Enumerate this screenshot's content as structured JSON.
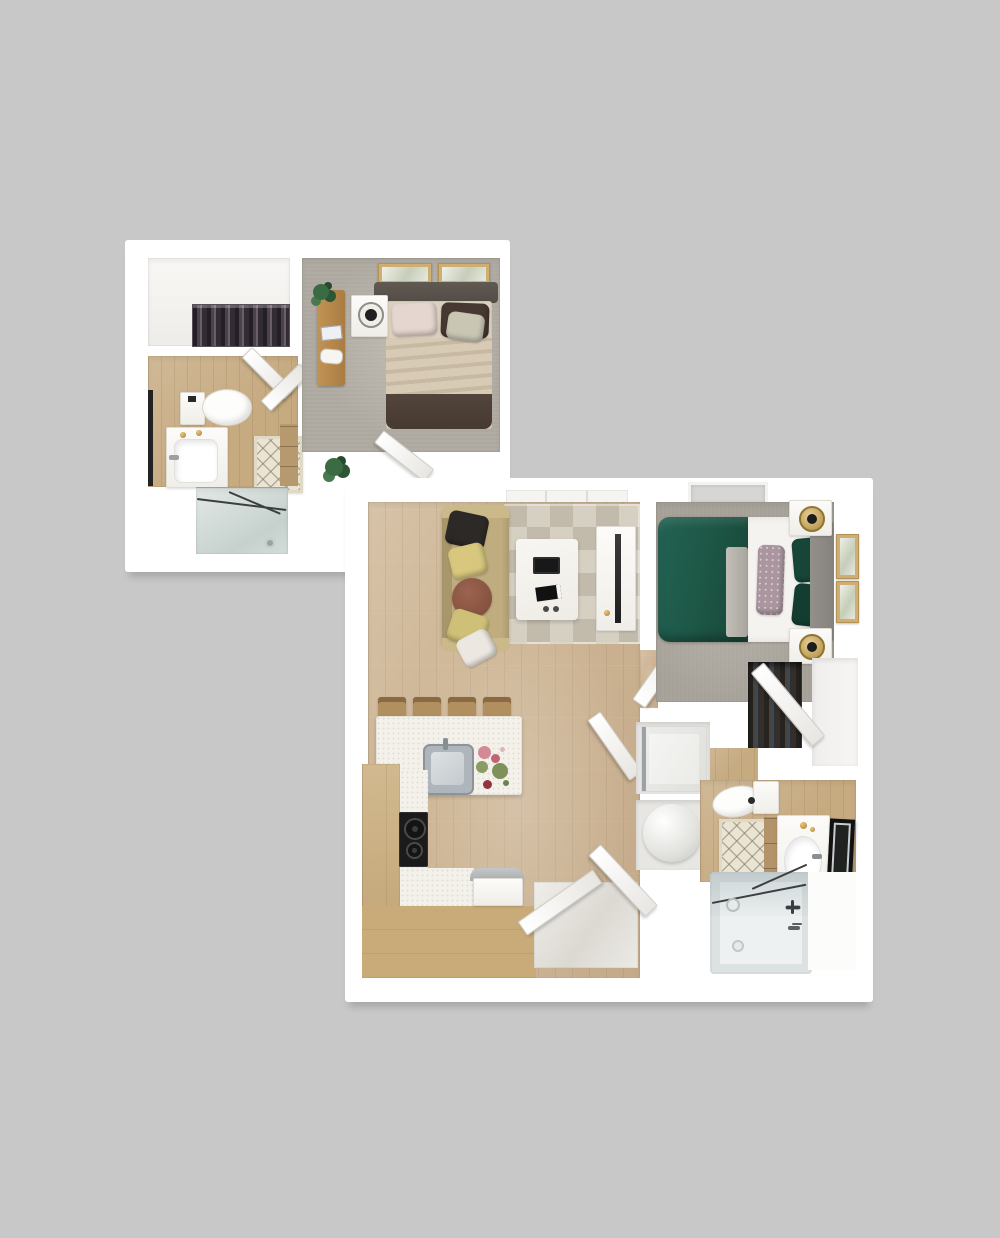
{
  "scene": {
    "title": "3D rendered apartment floor plan, top-down view, two white-walled sections on gray background",
    "background_color": "#c8c8c8",
    "units": [
      {
        "name": "upper bedroom suite",
        "rooms": [
          {
            "name": "walk-in closet",
            "items": [
              "hanging clothes rack"
            ]
          },
          {
            "name": "bathroom",
            "items": [
              "toilet",
              "white vanity with sink",
              "gold accessories",
              "diamond lattice bath mat",
              "wood drawer cabinet",
              "glass shower with showerhead",
              "open door leaves"
            ]
          },
          {
            "name": "bedroom",
            "items": [
              "double bed with beige striped duvet",
              "dark gray headboard",
              "blush pillow",
              "dark brown pillow",
              "sage pillow",
              "dark brown foot throw",
              "white nightstand with black lamp",
              "wood console bench with plant and books",
              "two framed artworks",
              "floor plant",
              "open door leaf"
            ]
          }
        ],
        "floor_finishes": {
          "closet": "white",
          "bathroom": "light oak wood",
          "bedroom": "gray carpet"
        }
      },
      {
        "name": "main one-bedroom unit",
        "rooms": [
          {
            "name": "living room",
            "items": [
              "tan sofa",
              "black pillow",
              "two yellow pillows",
              "rust round pillow",
              "white pillow",
              "geometric triangle area rug",
              "white coffee table with black tray and book",
              "white media console with TV"
            ]
          },
          {
            "name": "kitchen",
            "items": [
              "white island with stainless sink and flowers",
              "four wood bar stools",
              "L-shaped wood cabinets",
              "white speckled countertop",
              "black two-burner cooktop",
              "small silver bench"
            ]
          },
          {
            "name": "bedroom",
            "items": [
              "bed with dark green duvet and white sheets",
              "patterned lumbar pillow",
              "two dark green pillows",
              "gray headboard",
              "two white nightstands with brass lamps",
              "two framed artworks",
              "reach-in closet with open door and hanging clothes",
              "window"
            ]
          },
          {
            "name": "bathroom",
            "items": [
              "toilet",
              "diamond lattice bath mat",
              "wood cabinet",
              "white vanity with sink and gold soaps",
              "dark leaning mirror",
              "bathtub with glass screen and fixtures"
            ]
          },
          {
            "name": "utility closet",
            "items": [
              "washer-dryer",
              "round water heater tank"
            ]
          },
          {
            "name": "entry",
            "items": [
              "two open white door leaves",
              "skylight window band"
            ]
          }
        ],
        "floor_finishes": {
          "living_kitchen": "light oak wood",
          "bedroom": "gray carpet",
          "bathroom": "light oak wood with white tub zone"
        }
      }
    ],
    "palette": {
      "background": "#c8c8c8",
      "wall_white": "#ffffff",
      "wood_floor": "#cdb493",
      "bath_wood": "#c6aa80",
      "kitchen_cabinet": "#c9ab79",
      "carpet_gray": "#b1aca3",
      "sofa_tan": "#bfad7f",
      "duvet_green": "#1e5847",
      "dark_accent": "#1b1b1b",
      "glass": "#cdd6d3",
      "frame_tan": "#cfae72",
      "brass": "#b08d3f"
    },
    "counts": {
      "bar_stools": 4,
      "entry_doors": 2,
      "bedrooms": 2,
      "bathrooms": 2
    }
  }
}
